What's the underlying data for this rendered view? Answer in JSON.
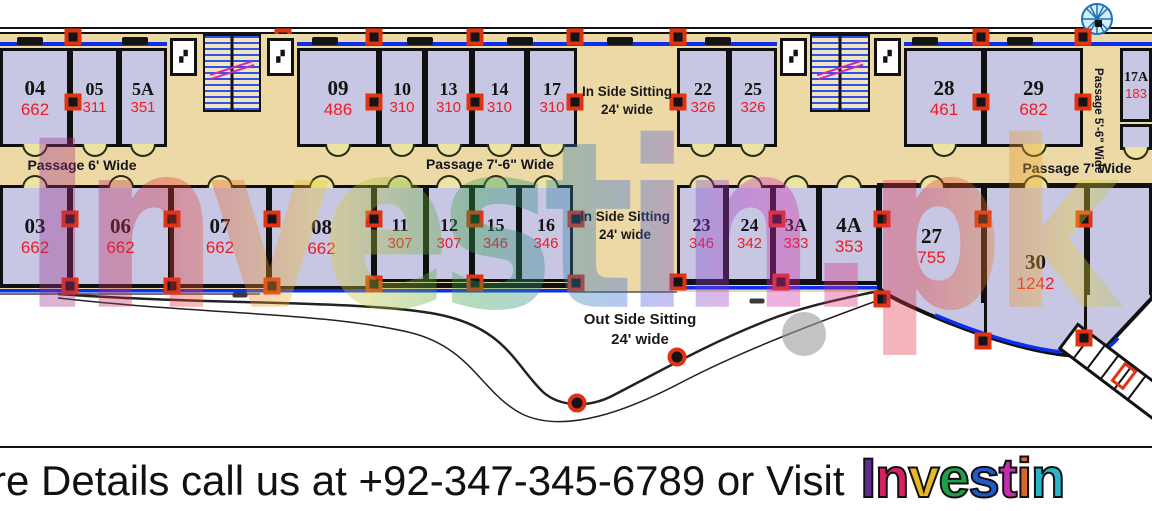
{
  "plan": {
    "watermark": "Investin.pk",
    "passages": {
      "p6": "Passage 6' Wide",
      "p76": "Passage 7'-6\" Wide",
      "p7": "Passage 7' Wide",
      "p56": "Passage 5'-6\" Wide"
    },
    "sitting": {
      "inside": "In Side Sitting",
      "outside": "Out Side Sitting",
      "wide": "24' wide"
    },
    "top_rooms": [
      {
        "no": "04",
        "area": "662",
        "x": 0,
        "y": 48,
        "w": 70,
        "h": 99,
        "door": "b"
      },
      {
        "no": "05",
        "area": "311",
        "x": 70,
        "y": 48,
        "w": 49,
        "h": 99,
        "door": "b"
      },
      {
        "no": "5A",
        "area": "351",
        "x": 119,
        "y": 48,
        "w": 48,
        "h": 99,
        "door": "b"
      },
      {
        "no": "09",
        "area": "486",
        "x": 297,
        "y": 48,
        "w": 82,
        "h": 99,
        "door": "b"
      },
      {
        "no": "10",
        "area": "310",
        "x": 379,
        "y": 48,
        "w": 46,
        "h": 99,
        "door": "b"
      },
      {
        "no": "13",
        "area": "310",
        "x": 425,
        "y": 48,
        "w": 47,
        "h": 99,
        "door": "b"
      },
      {
        "no": "14",
        "area": "310",
        "x": 472,
        "y": 48,
        "w": 55,
        "h": 99,
        "door": "b"
      },
      {
        "no": "17",
        "area": "310",
        "x": 527,
        "y": 48,
        "w": 50,
        "h": 99,
        "door": "b"
      },
      {
        "no": "22",
        "area": "326",
        "x": 677,
        "y": 48,
        "w": 52,
        "h": 99,
        "door": "b"
      },
      {
        "no": "25",
        "area": "326",
        "x": 729,
        "y": 48,
        "w": 48,
        "h": 99,
        "door": "b"
      },
      {
        "no": "28",
        "area": "461",
        "x": 904,
        "y": 48,
        "w": 80,
        "h": 99,
        "door": "b"
      },
      {
        "no": "29",
        "area": "682",
        "x": 984,
        "y": 48,
        "w": 99,
        "h": 99,
        "door": "b"
      },
      {
        "no": "17A",
        "area": "183",
        "x": 1120,
        "y": 48,
        "w": 32,
        "h": 74,
        "door": ""
      },
      {
        "no": "",
        "area": "",
        "x": 1120,
        "y": 124,
        "w": 32,
        "h": 26,
        "door": "b"
      }
    ],
    "bottom_rooms": [
      {
        "no": "03",
        "area": "662",
        "x": 0,
        "y": 185,
        "w": 70,
        "h": 102,
        "door": "t"
      },
      {
        "no": "06",
        "area": "662",
        "x": 70,
        "y": 185,
        "w": 101,
        "h": 102,
        "door": "t"
      },
      {
        "no": "07",
        "area": "662",
        "x": 171,
        "y": 185,
        "w": 98,
        "h": 102,
        "door": "t"
      },
      {
        "no": "08",
        "area": "662",
        "x": 269,
        "y": 185,
        "w": 105,
        "h": 104,
        "door": "t"
      },
      {
        "no": "11",
        "area": "307",
        "x": 374,
        "y": 185,
        "w": 52,
        "h": 97,
        "door": "t"
      },
      {
        "no": "12",
        "area": "307",
        "x": 426,
        "y": 185,
        "w": 46,
        "h": 97,
        "door": "t"
      },
      {
        "no": "15",
        "area": "346",
        "x": 472,
        "y": 185,
        "w": 47,
        "h": 97,
        "door": "t"
      },
      {
        "no": "16",
        "area": "346",
        "x": 519,
        "y": 185,
        "w": 54,
        "h": 97,
        "door": "t"
      },
      {
        "no": "23",
        "area": "346",
        "x": 677,
        "y": 185,
        "w": 49,
        "h": 97,
        "door": "t"
      },
      {
        "no": "24",
        "area": "342",
        "x": 726,
        "y": 185,
        "w": 47,
        "h": 97,
        "door": "t"
      },
      {
        "no": "3A",
        "area": "333",
        "x": 773,
        "y": 185,
        "w": 46,
        "h": 97,
        "door": "t"
      },
      {
        "no": "4A",
        "area": "353",
        "x": 819,
        "y": 185,
        "w": 60,
        "h": 99,
        "door": "t"
      },
      {
        "no": "27",
        "area": "755",
        "x": 879,
        "y": 185,
        "w": 105,
        "h": 118,
        "door": "t",
        "open": true
      },
      {
        "no": "30",
        "area": "1242",
        "x": 984,
        "y": 185,
        "w": 103,
        "h": 150,
        "door": "t",
        "open": true,
        "pt": 20
      },
      {
        "no": "",
        "area": "",
        "x": 1087,
        "y": 185,
        "w": 65,
        "h": 110,
        "door": "",
        "open": true
      }
    ],
    "columns": {
      "squares": [
        [
          73,
          37
        ],
        [
          283,
          37
        ],
        [
          374,
          37
        ],
        [
          475,
          37
        ],
        [
          575,
          37
        ],
        [
          678,
          37
        ],
        [
          981,
          37
        ],
        [
          1083,
          37
        ],
        [
          73,
          102
        ],
        [
          374,
          102
        ],
        [
          475,
          102
        ],
        [
          575,
          102
        ],
        [
          678,
          102
        ],
        [
          981,
          102
        ],
        [
          1083,
          102
        ],
        [
          70,
          219
        ],
        [
          172,
          219
        ],
        [
          272,
          219
        ],
        [
          374,
          219
        ],
        [
          475,
          219
        ],
        [
          576,
          219
        ],
        [
          777,
          219
        ],
        [
          882,
          219
        ],
        [
          983,
          219
        ],
        [
          1084,
          219
        ],
        [
          70,
          286
        ],
        [
          172,
          286
        ],
        [
          272,
          286
        ],
        [
          374,
          284
        ],
        [
          475,
          283
        ],
        [
          576,
          283
        ],
        [
          678,
          282
        ],
        [
          781,
          282
        ],
        [
          882,
          299
        ],
        [
          983,
          341
        ],
        [
          1084,
          338
        ]
      ],
      "circles": [
        [
          577,
          403
        ],
        [
          677,
          357
        ]
      ],
      "frames": [
        [
          1124,
          376
        ]
      ]
    },
    "window_marks": {
      "top_y": 41,
      "top_x": [
        30,
        135,
        325,
        420,
        520,
        620,
        718,
        925,
        1020
      ],
      "small": [
        [
          240,
          295
        ],
        [
          757,
          301
        ]
      ]
    }
  },
  "footer": {
    "details": "re Details call us at +92-347-345-6789 or Visit",
    "logo": "Investin",
    "logo_colors": [
      "#5b2d8e",
      "#d6235f",
      "#e8b820",
      "#1f9e4b",
      "#2059c9",
      "#c92bb0",
      "#d6672b",
      "#2bb3c9"
    ]
  }
}
